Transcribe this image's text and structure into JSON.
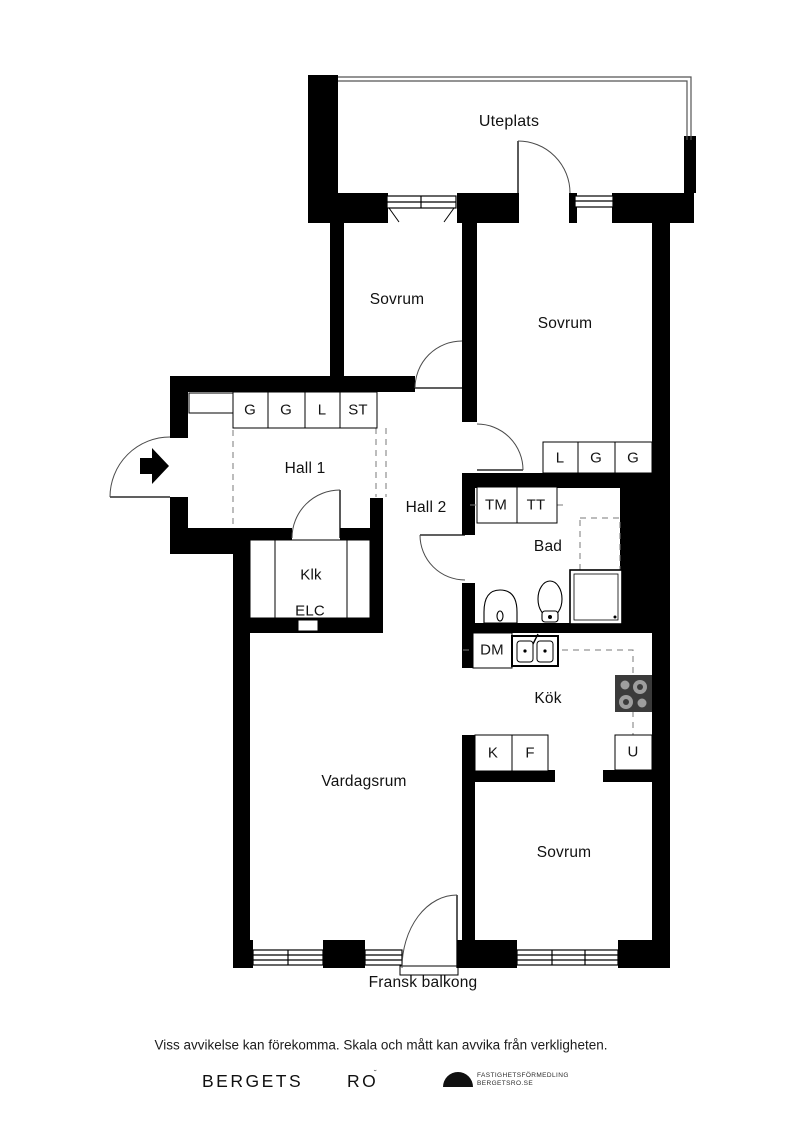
{
  "plan": {
    "rooms": {
      "uteplats": {
        "label": "Uteplats"
      },
      "sovrum_top_left": {
        "label": "Sovrum"
      },
      "sovrum_top_right": {
        "label": "Sovrum"
      },
      "hall1": {
        "label": "Hall 1"
      },
      "hall2": {
        "label": "Hall 2"
      },
      "klk": {
        "label": "Klk"
      },
      "elc": {
        "label": "ELC"
      },
      "bad": {
        "label": "Bad"
      },
      "kok": {
        "label": "Kök"
      },
      "vardagsrum": {
        "label": "Vardagsrum"
      },
      "sovrum_bottom": {
        "label": "Sovrum"
      },
      "fransk_balkong": {
        "label": "Fransk balkong"
      }
    },
    "closets": {
      "hall1_units": [
        "G",
        "G",
        "L",
        "ST"
      ],
      "bedroom_units": [
        "L",
        "G",
        "G"
      ],
      "laundry_units": [
        "TM",
        "TT"
      ],
      "kitchen_units": {
        "dm": "DM",
        "k": "K",
        "f": "F",
        "u": "U"
      }
    }
  },
  "footer": {
    "disclaimer": "Viss avvikelse kan förekomma. Skala och mått kan avvika från verkligheten."
  },
  "logo": {
    "brand_first": "BERGETS",
    "brand_second": "RO",
    "tagline_line1": "FASTIGHETSFÖRMEDLING",
    "tagline_line2": "BERGETSRO.SE"
  },
  "colors": {
    "wall": "#000000",
    "background": "#ffffff",
    "stove": "#3b3b3b",
    "burner": "#9e9e9e"
  }
}
